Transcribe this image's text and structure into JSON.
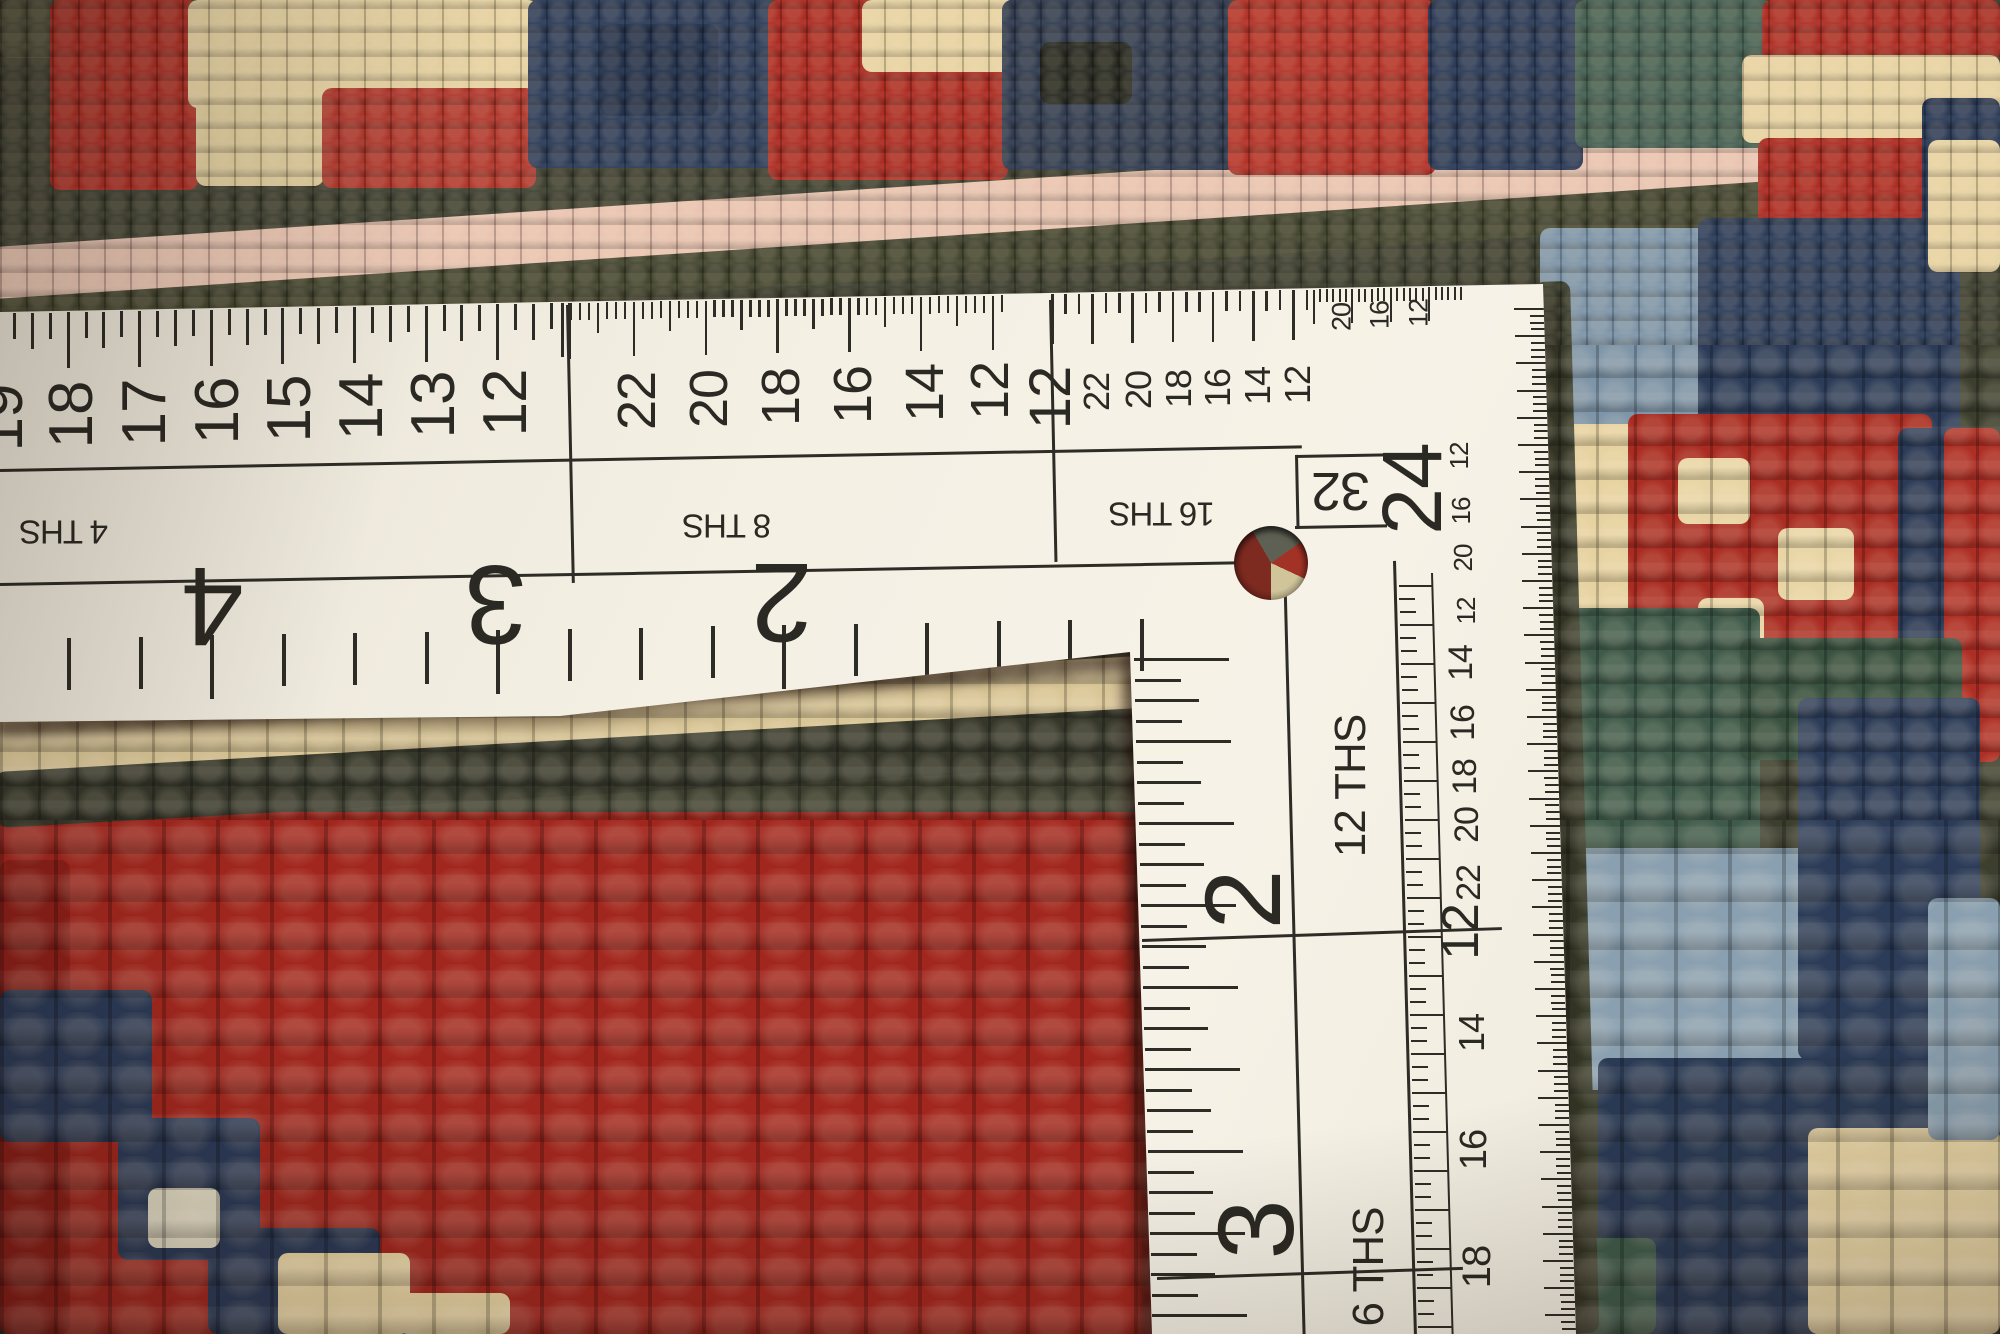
{
  "scene": {
    "alt": "Back side of a red hand-knotted oriental rug measured with a white L-square dressmaker ruler"
  },
  "ruler": {
    "paper_color": "#f4f0e4",
    "ink_color": "#2e2c26",
    "scale_labels": {
      "fourths": "4 THS",
      "eighths": "8 THS",
      "sixteenths": "16 THS",
      "thirty_seconds": "32",
      "twelfths": "12 THS",
      "sixths": "6 THS"
    },
    "horizontal_inch_numbers": [
      "4",
      "3",
      "2"
    ],
    "horizontal_4ths_numbers": [
      "19",
      "18",
      "17",
      "16",
      "15",
      "14",
      "13",
      "12"
    ],
    "horizontal_8ths_numbers": [
      "22",
      "20",
      "18",
      "16",
      "14",
      "12"
    ],
    "horizontal_16ths_numbers": [
      "12",
      "22",
      "20",
      "18",
      "16",
      "14",
      "12"
    ],
    "horizontal_fine_numbers": [
      "20",
      "16",
      "12"
    ],
    "vertical_inch_numbers": [
      "24",
      "2",
      "3"
    ],
    "vertical_12ths_numbers": [
      "14",
      "16",
      "18",
      "20",
      "22",
      "12",
      "14",
      "16",
      "18"
    ],
    "vertical_edge_numbers": [
      "12",
      "16",
      "20",
      "12"
    ],
    "texts": [
      {
        "t": "19",
        "x": 2,
        "y": 418,
        "s": 62,
        "r": -90,
        "k": "number"
      },
      {
        "t": "18",
        "x": 72,
        "y": 415,
        "s": 62,
        "r": -90,
        "k": "number"
      },
      {
        "t": "17",
        "x": 145,
        "y": 413,
        "s": 62,
        "r": -90,
        "k": "number"
      },
      {
        "t": "16",
        "x": 218,
        "y": 411,
        "s": 62,
        "r": -90,
        "k": "number"
      },
      {
        "t": "15",
        "x": 290,
        "y": 409,
        "s": 62,
        "r": -90,
        "k": "number"
      },
      {
        "t": "14",
        "x": 362,
        "y": 407,
        "s": 62,
        "r": -90,
        "k": "number"
      },
      {
        "t": "13",
        "x": 434,
        "y": 405,
        "s": 62,
        "r": -90,
        "k": "number"
      },
      {
        "t": "12",
        "x": 506,
        "y": 403,
        "s": 62,
        "r": -90,
        "k": "number"
      },
      {
        "t": "22",
        "x": 637,
        "y": 401,
        "s": 54,
        "r": -90,
        "k": "number"
      },
      {
        "t": "20",
        "x": 709,
        "y": 399,
        "s": 54,
        "r": -90,
        "k": "number"
      },
      {
        "t": "18",
        "x": 781,
        "y": 397,
        "s": 54,
        "r": -90,
        "k": "number"
      },
      {
        "t": "16",
        "x": 853,
        "y": 395,
        "s": 54,
        "r": -90,
        "k": "number"
      },
      {
        "t": "14",
        "x": 925,
        "y": 393,
        "s": 54,
        "r": -90,
        "k": "number"
      },
      {
        "t": "12",
        "x": 990,
        "y": 391,
        "s": 54,
        "r": -90,
        "k": "number"
      },
      {
        "t": "12",
        "x": 1051,
        "y": 398,
        "s": 58,
        "r": -90,
        "k": "number"
      },
      {
        "t": "22",
        "x": 1097,
        "y": 392,
        "s": 36,
        "r": -90,
        "k": "number"
      },
      {
        "t": "20",
        "x": 1139,
        "y": 390,
        "s": 36,
        "r": -90,
        "k": "number"
      },
      {
        "t": "18",
        "x": 1179,
        "y": 389,
        "s": 36,
        "r": -90,
        "k": "number"
      },
      {
        "t": "16",
        "x": 1218,
        "y": 388,
        "s": 36,
        "r": -90,
        "k": "number"
      },
      {
        "t": "14",
        "x": 1258,
        "y": 386,
        "s": 36,
        "r": -90,
        "k": "number"
      },
      {
        "t": "12",
        "x": 1298,
        "y": 385,
        "s": 36,
        "r": -90,
        "k": "number"
      },
      {
        "t": "20",
        "x": 1342,
        "y": 317,
        "s": 27,
        "r": -90,
        "k": "number"
      },
      {
        "t": "16",
        "x": 1380,
        "y": 315,
        "s": 27,
        "r": -90,
        "k": "number"
      },
      {
        "t": "12",
        "x": 1419,
        "y": 313,
        "s": 27,
        "r": -90,
        "k": "number"
      },
      {
        "t": "4 THS",
        "x": 64,
        "y": 532,
        "s": 33,
        "r": 180,
        "k": "label"
      },
      {
        "t": "8 THS",
        "x": 727,
        "y": 526,
        "s": 33,
        "r": 180,
        "k": "label"
      },
      {
        "t": "16 THS",
        "x": 1162,
        "y": 514,
        "s": 33,
        "r": 180,
        "k": "label"
      },
      {
        "t": "32",
        "x": 1341,
        "y": 491,
        "s": 54,
        "r": 180,
        "k": "label"
      },
      {
        "t": "4",
        "x": 213,
        "y": 606,
        "s": 112,
        "r": 180,
        "k": "number"
      },
      {
        "t": "3",
        "x": 496,
        "y": 604,
        "s": 112,
        "r": 180,
        "k": "number"
      },
      {
        "t": "2",
        "x": 782,
        "y": 602,
        "s": 112,
        "r": 180,
        "k": "number"
      },
      {
        "t": "24",
        "x": 1412,
        "y": 489,
        "s": 84,
        "r": -90,
        "k": "number"
      },
      {
        "t": "2",
        "x": 1243,
        "y": 900,
        "s": 108,
        "r": -90,
        "k": "number"
      },
      {
        "t": "3",
        "x": 1256,
        "y": 1230,
        "s": 108,
        "r": -90,
        "k": "number"
      },
      {
        "t": "12 THS",
        "x": 1351,
        "y": 786,
        "s": 44,
        "r": -90,
        "k": "label"
      },
      {
        "t": "6 THS",
        "x": 1369,
        "y": 1267,
        "s": 44,
        "r": -90,
        "k": "label"
      },
      {
        "t": "14",
        "x": 1461,
        "y": 663,
        "s": 34,
        "r": -90,
        "k": "number"
      },
      {
        "t": "16",
        "x": 1463,
        "y": 723,
        "s": 34,
        "r": -90,
        "k": "number"
      },
      {
        "t": "18",
        "x": 1465,
        "y": 777,
        "s": 34,
        "r": -90,
        "k": "number"
      },
      {
        "t": "20",
        "x": 1467,
        "y": 825,
        "s": 34,
        "r": -90,
        "k": "number"
      },
      {
        "t": "22",
        "x": 1469,
        "y": 883,
        "s": 34,
        "r": -90,
        "k": "number"
      },
      {
        "t": "12",
        "x": 1461,
        "y": 932,
        "s": 52,
        "r": -90,
        "k": "number"
      },
      {
        "t": "14",
        "x": 1472,
        "y": 1033,
        "s": 36,
        "r": -90,
        "k": "number"
      },
      {
        "t": "16",
        "x": 1474,
        "y": 1150,
        "s": 38,
        "r": -90,
        "k": "number"
      },
      {
        "t": "18",
        "x": 1477,
        "y": 1267,
        "s": 40,
        "r": -90,
        "k": "number"
      },
      {
        "t": "12",
        "x": 1459,
        "y": 456,
        "s": 26,
        "r": -90,
        "k": "number"
      },
      {
        "t": "16",
        "x": 1461,
        "y": 511,
        "s": 26,
        "r": -90,
        "k": "number"
      },
      {
        "t": "20",
        "x": 1463,
        "y": 558,
        "s": 26,
        "r": -90,
        "k": "number"
      },
      {
        "t": "12",
        "x": 1466,
        "y": 611,
        "s": 26,
        "r": -90,
        "k": "number"
      }
    ],
    "lines": [
      {
        "x": 0,
        "y": 469,
        "w": 1302,
        "h": 3,
        "r": -1.04
      },
      {
        "x": 0,
        "y": 583,
        "w": 1300,
        "h": 3,
        "r": -1.0
      },
      {
        "x": 566,
        "y": 305,
        "w": 3,
        "h": 278,
        "r": -1.2
      },
      {
        "x": 1049,
        "y": 300,
        "w": 3,
        "h": 262,
        "r": -1.2
      },
      {
        "x": 1295,
        "y": 455,
        "w": 92,
        "h": 3,
        "r": -1.0
      },
      {
        "x": 1295,
        "y": 455,
        "w": 3,
        "h": 74,
        "r": -1.2
      },
      {
        "x": 1295,
        "y": 526,
        "w": 92,
        "h": 3,
        "r": -1.0
      },
      {
        "x": 1283,
        "y": 561,
        "w": 3,
        "h": 775,
        "r": -1.45
      },
      {
        "x": 1393,
        "y": 561,
        "w": 3,
        "h": 775,
        "r": -1.55
      },
      {
        "x": 1431,
        "y": 573,
        "w": 2,
        "h": 762,
        "r": -1.55
      },
      {
        "x": 1142,
        "y": 939,
        "w": 360,
        "h": 3,
        "r": -1.9
      },
      {
        "x": 1157,
        "y": 1277,
        "w": 306,
        "h": 3,
        "r": -1.9
      }
    ],
    "tick_groups": [
      {
        "v": true,
        "x0": -5,
        "y0": 313.5,
        "sx": 17.9,
        "sy": -0.33,
        "n": 33,
        "w": 3,
        "lens": [
          56,
          26,
          36,
          26
        ]
      },
      {
        "v": true,
        "x0": 561,
        "y0": 303.2,
        "sx": 8.97,
        "sy": -0.16,
        "n": 50,
        "w": 2.5,
        "lens": [
          54,
          17,
          17,
          17,
          30,
          17,
          17,
          17
        ]
      },
      {
        "v": true,
        "x0": 1051,
        "y0": 294.4,
        "sx": 13.4,
        "sy": -0.24,
        "n": 20,
        "w": 2.5,
        "lens": [
          50,
          20,
          20
        ]
      },
      {
        "v": true,
        "x0": 1313,
        "y0": 289.6,
        "sx": 6.4,
        "sy": -0.12,
        "n": 24,
        "w": 2,
        "lens": [
          34,
          13,
          13,
          13,
          13,
          13
        ]
      },
      {
        "v": false,
        "x0": 1544,
        "y0": 308,
        "sx": 0.21,
        "sy": 6.8,
        "n": 151,
        "w": 2,
        "lens": [
          30,
          14,
          14,
          14
        ],
        "dir": -1
      },
      {
        "v": false,
        "x0": 1399,
        "y0": 585,
        "sx": 0.34,
        "sy": 13,
        "n": 58,
        "w": 2,
        "lens": [
          34,
          16,
          16
        ],
        "dir": 1
      },
      {
        "v": false,
        "x0": 1134,
        "y0": 658,
        "sx": 0.57,
        "sy": 20.5,
        "n": 33,
        "w": 3,
        "lens": [
          95,
          46,
          64,
          46
        ],
        "dir": 1
      },
      {
        "v": true,
        "x0": 67,
        "y0": 638,
        "sx": 71.5,
        "sy": -1.29,
        "n": 16,
        "w": 4,
        "lens": [
          52,
          52,
          64,
          52
        ]
      }
    ]
  },
  "rug": {
    "palette": {
      "red": "#a8291f",
      "bright_red": "#b23227",
      "dark_red": "#8c1f18",
      "cream": "#e7d3a2",
      "light_cream": "#e8d5a5",
      "navy": "#2b3a56",
      "dark_navy": "#22304a",
      "light_blue": "#8aa0b0",
      "steel_blue": "#7e95a8",
      "teal": "#466052",
      "dark_teal": "#3f5a4a",
      "olive": "#3e4030",
      "pink": "#e9c4b1",
      "black_green": "#26281f"
    },
    "patches": [
      {
        "x": -20,
        "y": 198,
        "w": 2090,
        "h": 104,
        "c": "#3e4030",
        "r": -3.8
      },
      {
        "x": -20,
        "y": 248,
        "w": 2090,
        "h": 58,
        "c": "#e9c4b1",
        "r": -3.8
      },
      {
        "x": -20,
        "y": 300,
        "w": 2090,
        "h": 40,
        "c": "#43452f",
        "r": -3.8
      },
      {
        "x": 0,
        "y": 0,
        "w": 78,
        "h": 58,
        "c": "#4b4d37"
      },
      {
        "x": 50,
        "y": 0,
        "w": 148,
        "h": 190,
        "c": "#ac2d23"
      },
      {
        "x": 188,
        "y": 0,
        "w": 350,
        "h": 108,
        "c": "#e7d3a2"
      },
      {
        "x": 196,
        "y": 98,
        "w": 128,
        "h": 88,
        "c": "#e2cf9e"
      },
      {
        "x": 322,
        "y": 88,
        "w": 214,
        "h": 100,
        "c": "#b0372c"
      },
      {
        "x": 528,
        "y": 0,
        "w": 248,
        "h": 168,
        "c": "#2b3a56"
      },
      {
        "x": 600,
        "y": 24,
        "w": 118,
        "h": 92,
        "c": "#22304a"
      },
      {
        "x": 768,
        "y": 0,
        "w": 240,
        "h": 180,
        "c": "#ab2c22"
      },
      {
        "x": 862,
        "y": 0,
        "w": 155,
        "h": 72,
        "c": "#e7d3a2"
      },
      {
        "x": 1002,
        "y": 0,
        "w": 235,
        "h": 170,
        "c": "#2f3a4e"
      },
      {
        "x": 1040,
        "y": 42,
        "w": 92,
        "h": 62,
        "c": "#26281f"
      },
      {
        "x": 1228,
        "y": 0,
        "w": 208,
        "h": 175,
        "c": "#b23227"
      },
      {
        "x": 1428,
        "y": 0,
        "w": 155,
        "h": 170,
        "c": "#2b3a56"
      },
      {
        "x": 1575,
        "y": 0,
        "w": 198,
        "h": 148,
        "c": "#466052"
      },
      {
        "x": 1762,
        "y": 0,
        "w": 238,
        "h": 62,
        "c": "#ac2d23"
      },
      {
        "x": 1742,
        "y": 55,
        "w": 258,
        "h": 88,
        "c": "#e7d3a2"
      },
      {
        "x": 1758,
        "y": 138,
        "w": 242,
        "h": 125,
        "c": "#ab2c22"
      },
      {
        "x": 1922,
        "y": 98,
        "w": 78,
        "h": 165,
        "c": "#2b3a56"
      },
      {
        "x": 1540,
        "y": 228,
        "w": 182,
        "h": 212,
        "c": "#7e95a8"
      },
      {
        "x": 1698,
        "y": 218,
        "w": 262,
        "h": 218,
        "c": "#2c3c58"
      },
      {
        "x": 1928,
        "y": 140,
        "w": 72,
        "h": 132,
        "c": "#e7d3a2"
      },
      {
        "x": 1543,
        "y": 424,
        "w": 132,
        "h": 202,
        "c": "#e6d2a0"
      },
      {
        "x": 1628,
        "y": 414,
        "w": 304,
        "h": 312,
        "c": "#a92c22"
      },
      {
        "x": 1678,
        "y": 458,
        "w": 72,
        "h": 66,
        "c": "#e8d5a5"
      },
      {
        "x": 1778,
        "y": 528,
        "w": 76,
        "h": 72,
        "c": "#e8d5a5"
      },
      {
        "x": 1698,
        "y": 598,
        "w": 66,
        "h": 62,
        "c": "#e8d5a5"
      },
      {
        "x": 1898,
        "y": 428,
        "w": 102,
        "h": 232,
        "c": "#2b3a56"
      },
      {
        "x": 1944,
        "y": 428,
        "w": 56,
        "h": 334,
        "c": "#ad2e24"
      },
      {
        "x": 1538,
        "y": 608,
        "w": 222,
        "h": 272,
        "c": "#3f5a4a"
      },
      {
        "x": 1740,
        "y": 638,
        "w": 222,
        "h": 122,
        "c": "#39513f"
      },
      {
        "x": 1558,
        "y": 848,
        "w": 262,
        "h": 242,
        "c": "#8aa0b0"
      },
      {
        "x": 1798,
        "y": 698,
        "w": 182,
        "h": 362,
        "c": "#2c3c58"
      },
      {
        "x": 1598,
        "y": 1058,
        "w": 362,
        "h": 276,
        "c": "#2a3a54"
      },
      {
        "x": 1808,
        "y": 1128,
        "w": 192,
        "h": 206,
        "c": "#e8d5a5"
      },
      {
        "x": 1928,
        "y": 898,
        "w": 72,
        "h": 242,
        "c": "#8aa0b0"
      },
      {
        "x": 1572,
        "y": 1238,
        "w": 84,
        "h": 96,
        "c": "#3f5a4a"
      },
      {
        "x": 1534,
        "y": 282,
        "w": 36,
        "h": 1052,
        "c": "#3a3e2d",
        "r": -1.6
      },
      {
        "x": 0,
        "y": 812,
        "w": 1162,
        "h": 522,
        "c": "#a1271e"
      },
      {
        "x": -5,
        "y": 720,
        "w": 1150,
        "h": 58,
        "c": "#d9c697",
        "r": -3.2
      },
      {
        "x": -5,
        "y": 772,
        "w": 1150,
        "h": 56,
        "c": "#35372a",
        "r": -3.2
      },
      {
        "x": 0,
        "y": 860,
        "w": 70,
        "h": 474,
        "c": "#8c1f18"
      },
      {
        "x": 0,
        "y": 990,
        "w": 152,
        "h": 152,
        "c": "#2b3a56"
      },
      {
        "x": 118,
        "y": 1118,
        "w": 142,
        "h": 142,
        "c": "#2b3a56"
      },
      {
        "x": 208,
        "y": 1228,
        "w": 172,
        "h": 106,
        "c": "#2b3a56"
      },
      {
        "x": 318,
        "y": 1298,
        "w": 152,
        "h": 36,
        "c": "#2b3a56"
      },
      {
        "x": 148,
        "y": 1188,
        "w": 72,
        "h": 60,
        "c": "#dfd9c2"
      },
      {
        "x": 278,
        "y": 1253,
        "w": 132,
        "h": 81,
        "c": "#e7d3a2"
      },
      {
        "x": 398,
        "y": 1293,
        "w": 112,
        "h": 41,
        "c": "#e7d3a2"
      },
      {
        "x": -2,
        "y": 722,
        "w": 1145,
        "h": 16,
        "c": "rgba(25,12,8,0.5)",
        "b": 5,
        "r": -3.3
      },
      {
        "x": 1122,
        "y": 640,
        "w": 16,
        "h": 700,
        "c": "rgba(25,12,8,0.45)",
        "b": 5,
        "r": -1.5
      },
      {
        "x": 1548,
        "y": 292,
        "w": 12,
        "h": 1044,
        "c": "rgba(25,12,8,0.3)",
        "b": 6,
        "r": -1.6
      }
    ]
  }
}
